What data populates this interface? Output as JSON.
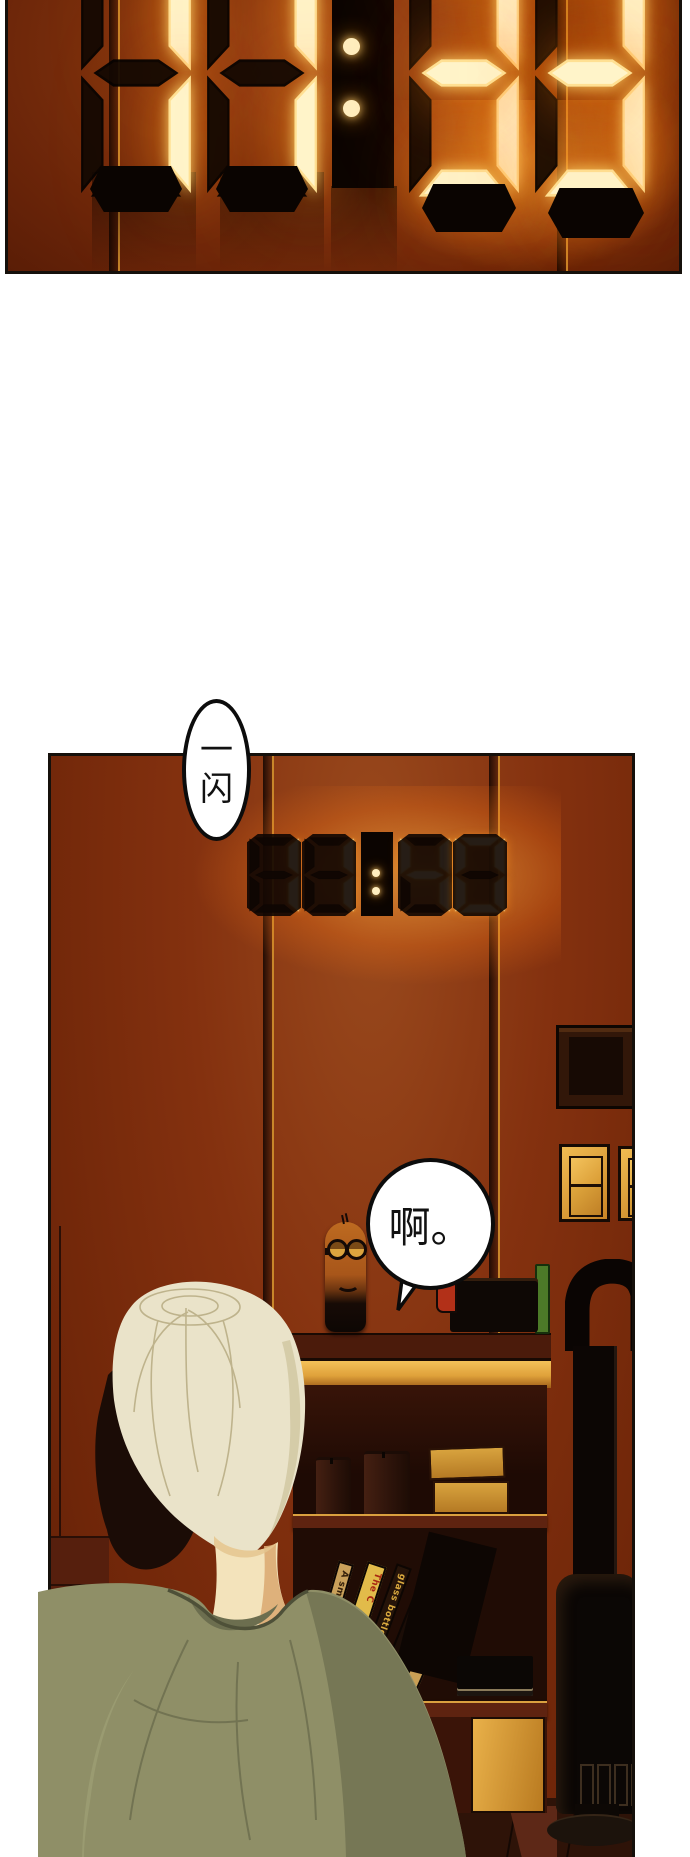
{
  "comic": {
    "panel1": {
      "clock_time": "11:33"
    },
    "panel2": {
      "clock_time": "11:40",
      "bubble_flash": {
        "text": "一闪",
        "chars": [
          "一",
          "闪"
        ]
      },
      "bubble_ah": {
        "text": "啊。"
      },
      "bookshelf_spines": [
        {
          "text": "A smal",
          "bg": "#c9a05a",
          "fg": "#35200a"
        },
        {
          "text": "The C",
          "bg": "#e2bb4a",
          "fg": "#a82812"
        },
        {
          "text": "glass bottles",
          "bg": "#261409",
          "fg": "#d9a93e"
        },
        {
          "text": "speeches and p",
          "bg": "#1b0d07",
          "fg": "#c9a05a"
        },
        {
          "text": "The Cambridge",
          "bg": "#c99f55",
          "fg": "#a32c12"
        }
      ]
    },
    "colors": {
      "wall": "#7c2e12",
      "panel_border": "#15100b",
      "led_lit": "#fff4c9",
      "led_glow": "#ff9c1e",
      "led_off": "#120802",
      "gold_trim": "#c8862a",
      "hair": "#eae3c9",
      "skin": "#f3e3bb",
      "sweater": "#8f8f67",
      "shelf_gold": "#e8ab42",
      "stove": "#0b0705",
      "bubble_bg": "#ffffff",
      "bubble_border": "#0c0c0c"
    }
  }
}
